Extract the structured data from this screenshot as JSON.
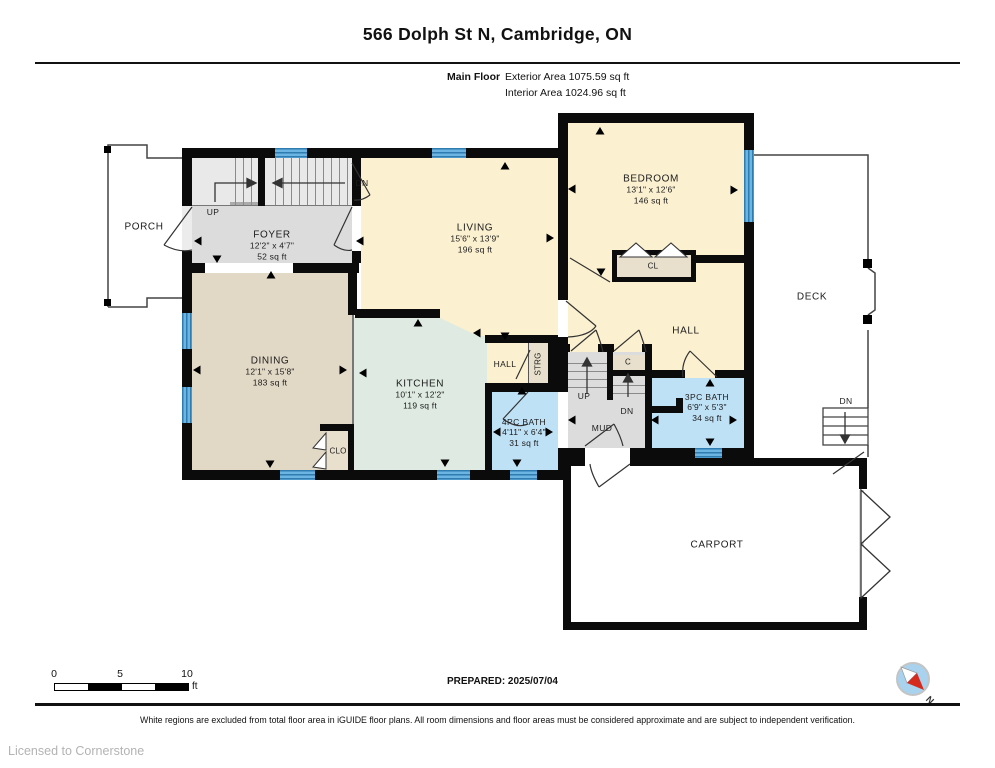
{
  "header": {
    "title": "566 Dolph St N, Cambridge, ON",
    "floor_label": "Main Floor",
    "exterior_area": "Exterior Area 1075.59 sq ft",
    "interior_area": "Interior Area 1024.96 sq ft"
  },
  "rooms": {
    "porch": {
      "name": "PORCH"
    },
    "foyer": {
      "name": "FOYER",
      "dims": "12'2\" x 4'7\"",
      "area": "52 sq ft"
    },
    "living": {
      "name": "LIVING",
      "dims": "15'6\" x 13'9\"",
      "area": "196 sq ft"
    },
    "bedroom": {
      "name": "BEDROOM",
      "dims": "13'1\" x 12'6\"",
      "area": "146 sq ft"
    },
    "dining": {
      "name": "DINING",
      "dims": "12'1\" x 15'8\"",
      "area": "183 sq ft"
    },
    "kitchen": {
      "name": "KITCHEN",
      "dims": "10'1\" x 12'2\"",
      "area": "119 sq ft"
    },
    "bath4": {
      "name": "4PC BATH",
      "dims": "4'11\" x 6'4\"",
      "area": "31 sq ft"
    },
    "bath3": {
      "name": "3PC BATH",
      "dims": "6'9\" x 5'3\"",
      "area": "34 sq ft"
    },
    "hall_upper": {
      "name": "HALL"
    },
    "hall_small": {
      "name": "HALL"
    },
    "mud": {
      "name": "MUD"
    },
    "deck": {
      "name": "DECK"
    },
    "carport": {
      "name": "CARPORT"
    },
    "cl": {
      "name": "CL"
    },
    "clo": {
      "name": "CLO"
    },
    "c_closet": {
      "name": "C"
    },
    "strg": {
      "name": "STRG"
    }
  },
  "stairs": {
    "up": "UP",
    "down": "DN",
    "living_down": "DN",
    "deck_down": "DN"
  },
  "footer": {
    "prepared": "PREPARED: 2025/07/04",
    "disclaimer": "White regions are excluded from total floor area in iGUIDE floor plans. All room dimensions and floor areas must be considered approximate and are subject to independent verification.",
    "license": "Licensed to Cornerstone",
    "compass_n": "N",
    "scale": {
      "t0": "0",
      "t5": "5",
      "t10": "10",
      "unit": "ft"
    }
  },
  "colors": {
    "wall": "#0b0b0b",
    "cream": "#FBF0D0",
    "dining_tan": "#E2D8C6",
    "kitchen_green": "#DFEBE2",
    "floor_gray": "#DCDCDC",
    "bath_blue": "#BFE1F6",
    "closet_beige": "#E8DFCC",
    "window_blue": "#58A7D7",
    "compass_blue": "#A9D2EE",
    "compass_red": "#D42B1E"
  }
}
